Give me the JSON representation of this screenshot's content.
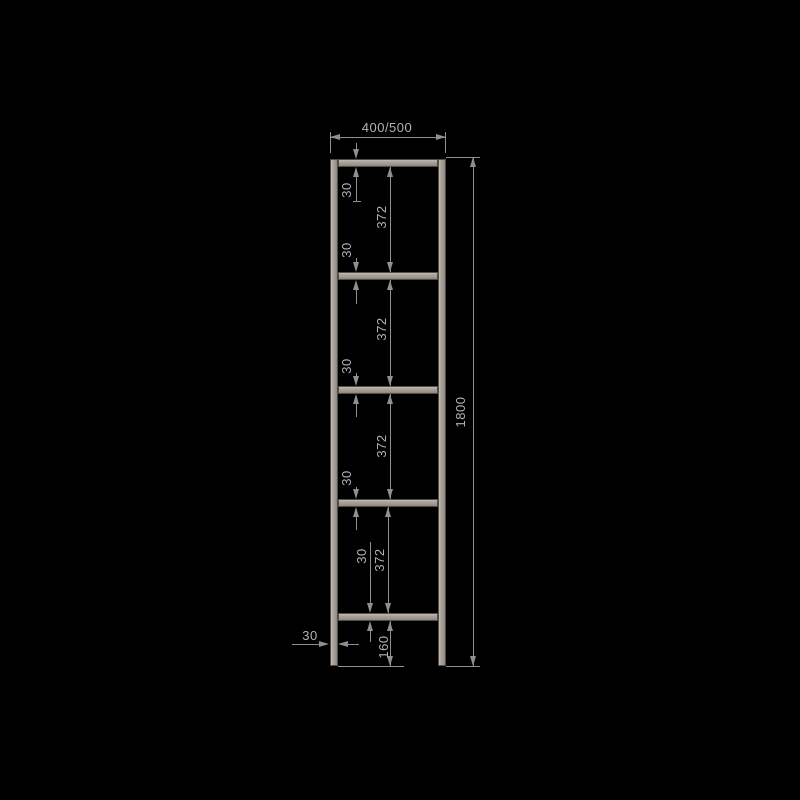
{
  "drawing": {
    "type": "ladder-frame-technical-drawing",
    "width_label": "400/500",
    "total_height_label": "1800",
    "rung_thickness_label": "30",
    "rung_gap_label": "372",
    "bottom_offset_label": "160",
    "rail_width_label": "30",
    "rung_count": 5
  },
  "colors": {
    "background": "#000000",
    "bar_fill": "#a59d94",
    "bar_edge": "#544e48",
    "dimension_line": "#8f8f8f",
    "dimension_text": "#b2b2b2"
  }
}
